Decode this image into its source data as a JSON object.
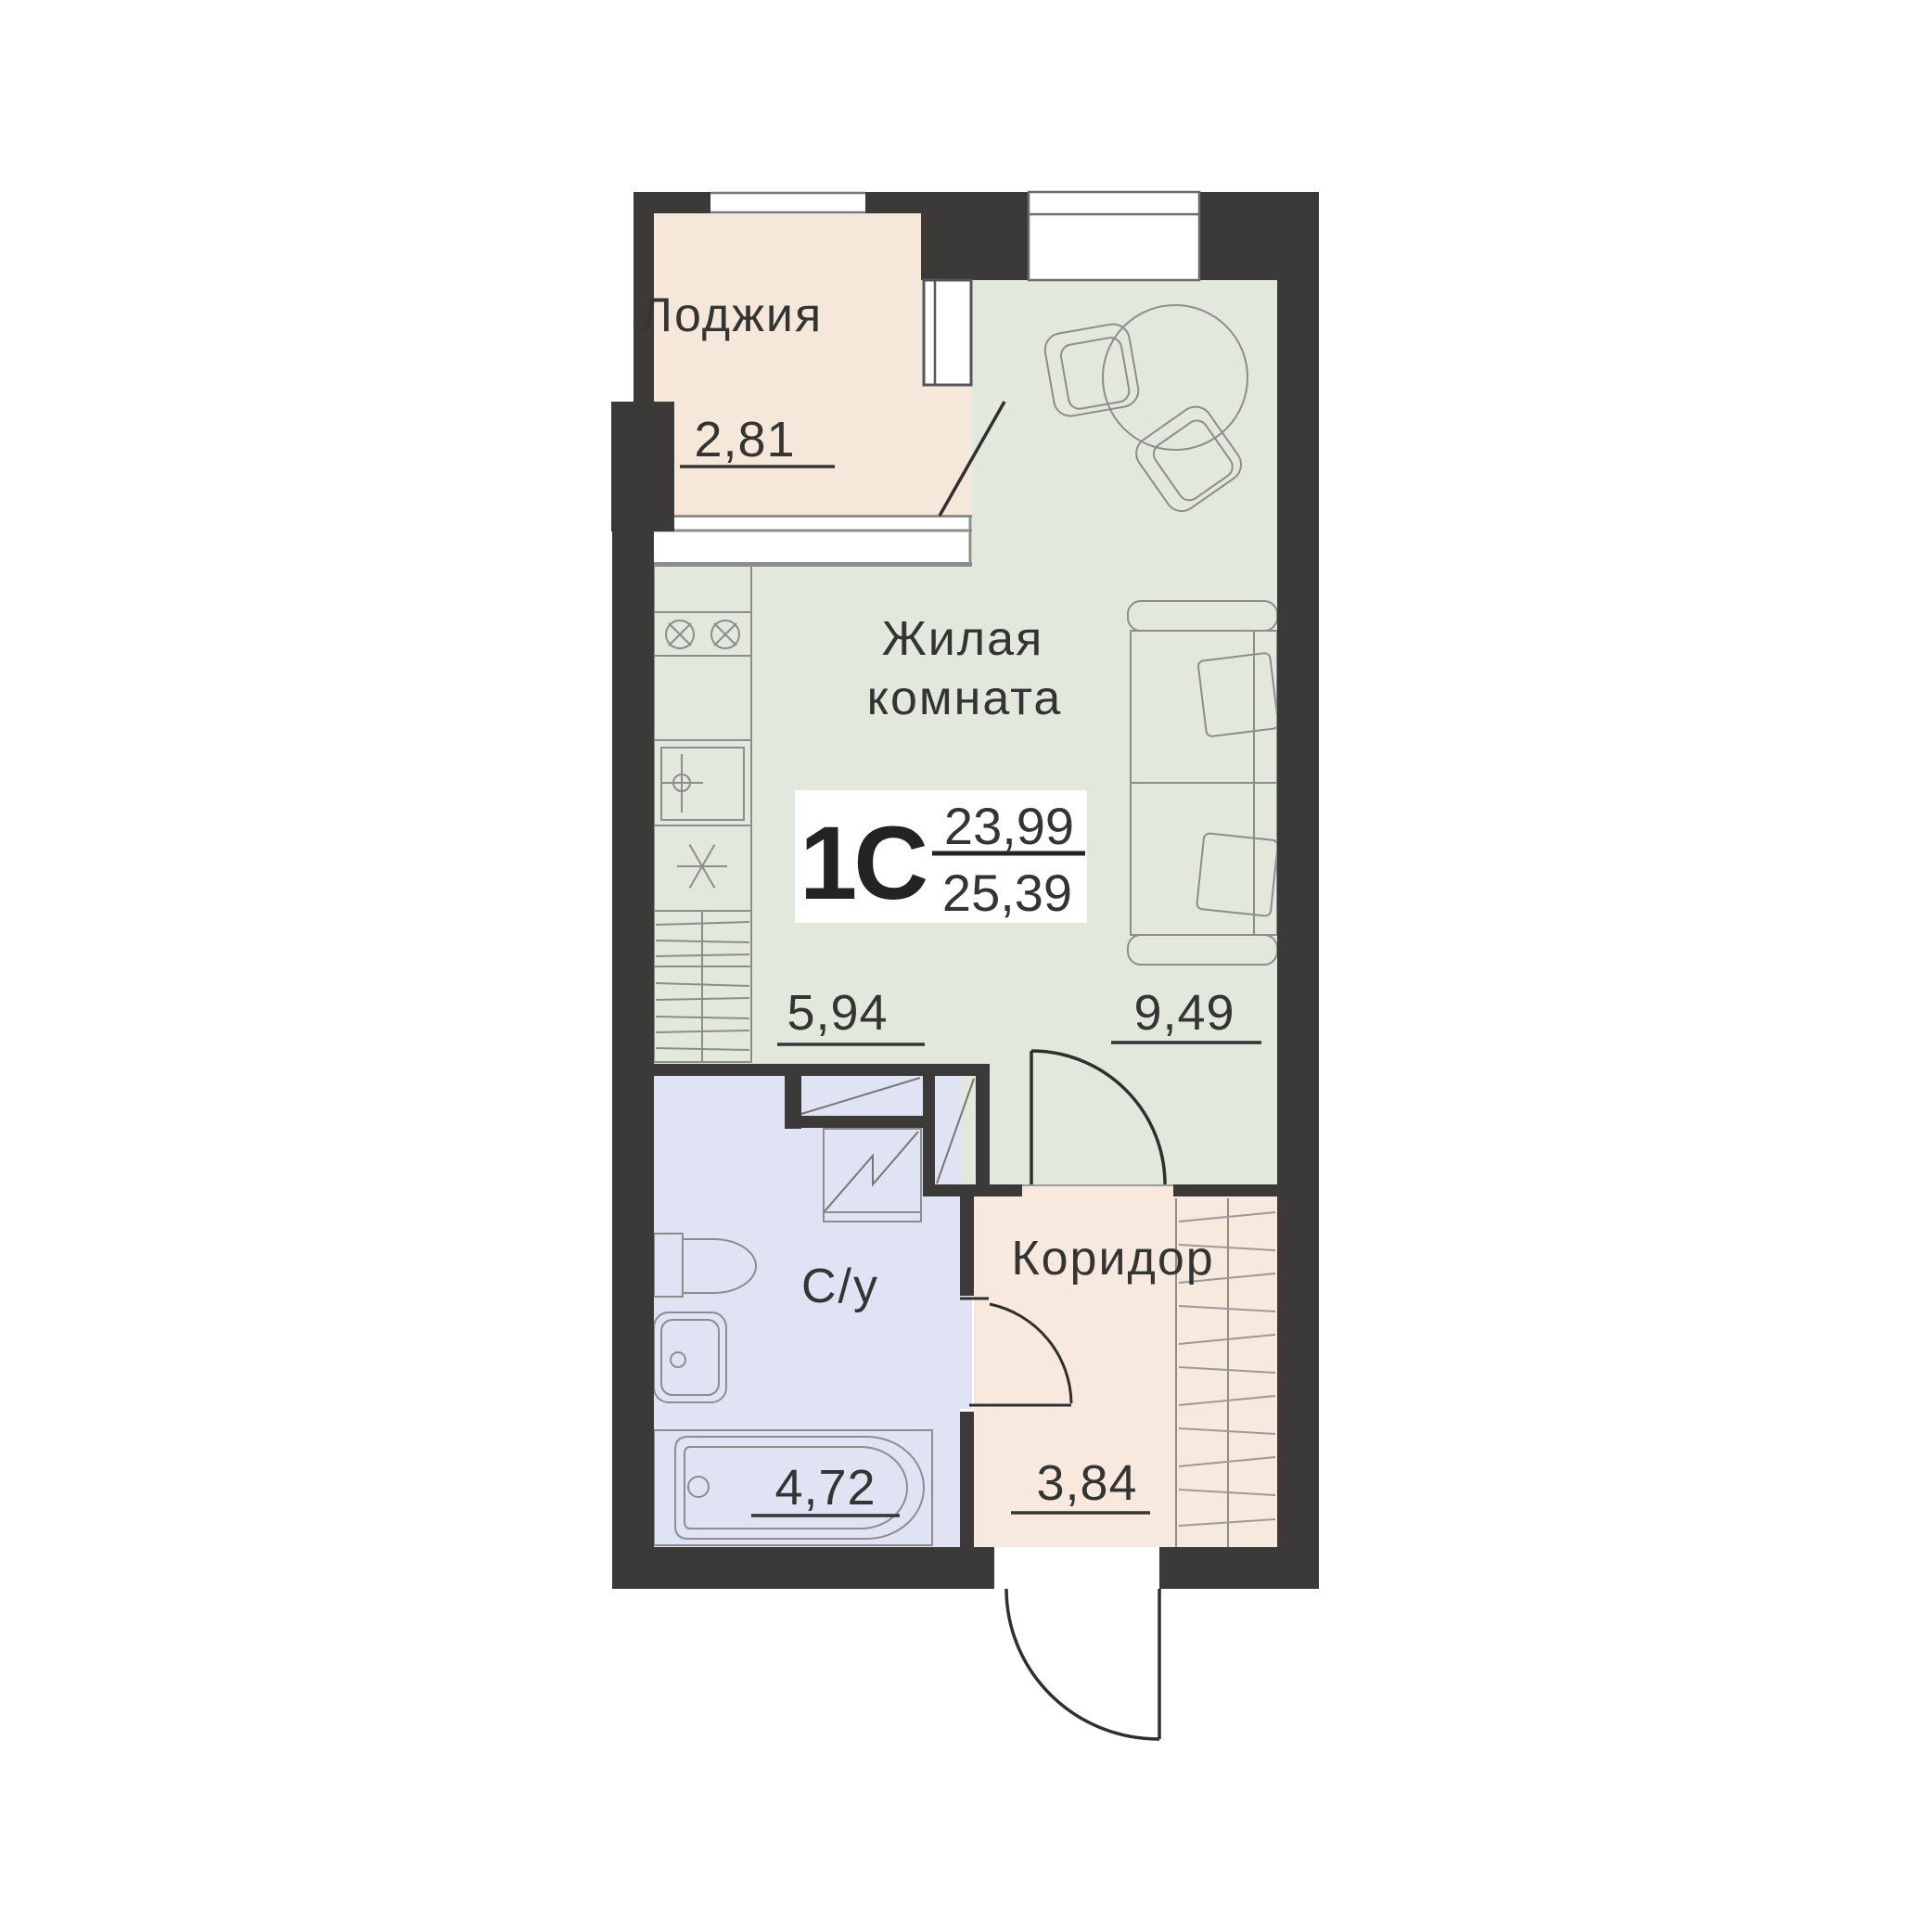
{
  "title_block": {
    "type_label": "1С",
    "area_living": "23,99",
    "area_total": "25,39"
  },
  "rooms": {
    "loggia": {
      "label": "Лоджия",
      "area": "2,81"
    },
    "living": {
      "label_line1": "Жилая",
      "label_line2": "комната",
      "kitchen_zone_area": "5,94",
      "living_zone_area": "9,49"
    },
    "bathroom": {
      "label": "С/у",
      "area": "4,72"
    },
    "corridor": {
      "label": "Коридор",
      "area": "3,84"
    }
  },
  "colors": {
    "wall": "#3b3a38",
    "loggia_floor": "#f6e7db",
    "living_floor": "#e2e8dc",
    "bathroom_floor": "#e0e3f4",
    "corridor_floor": "#f8e9de",
    "furniture_outline": "#8d8d8b",
    "text": "#343432"
  }
}
